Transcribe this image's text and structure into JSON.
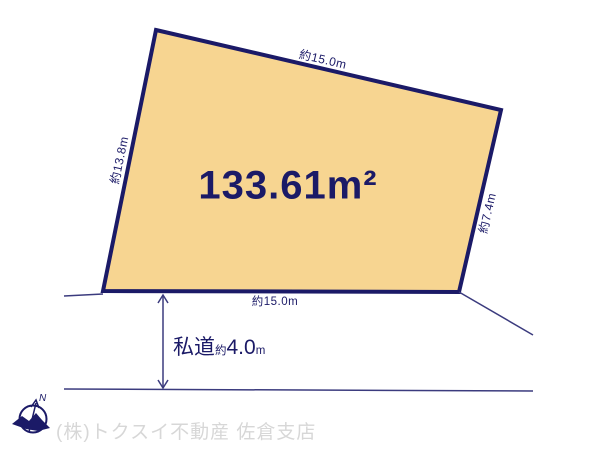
{
  "diagram": {
    "area_label": "133.61m²",
    "dim_top": "約15.0m",
    "dim_left": "約13.8m",
    "dim_right": "約7.4m",
    "dim_bottom": "約15.0m",
    "road": {
      "name": "私道",
      "approx": "約",
      "value": "4.0",
      "unit": "m"
    },
    "compass_north": "N",
    "watermark": "(株)トクスイ不動産 佐倉支店",
    "colors": {
      "plot_fill": "#F7D591",
      "line_navy": "#1B1A67",
      "thin_line": "#3B3B7E",
      "watermark_gray": "#D7D7D7",
      "background": "#FFFFFF"
    }
  }
}
